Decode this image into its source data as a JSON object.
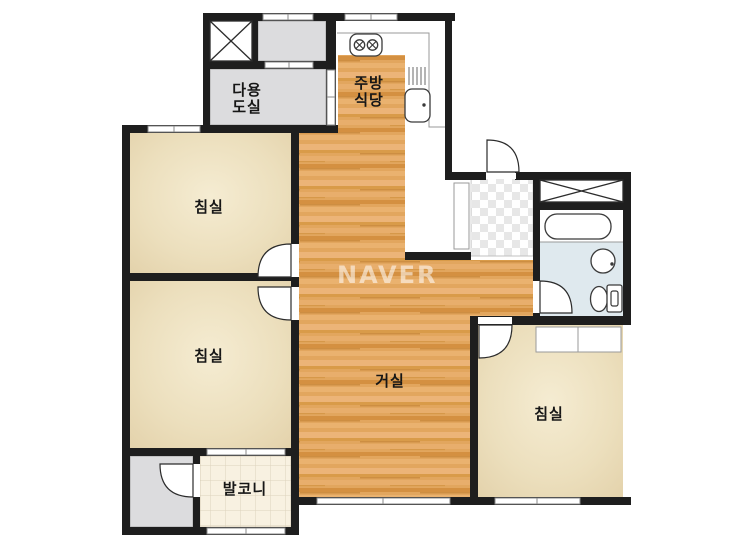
{
  "labels": {
    "utility_line1": "다용",
    "utility_line2": "도실",
    "kitchen_line1": "주방",
    "kitchen_line2": "식당",
    "bedroom_top_left": "침실",
    "bedroom_bottom_left": "침실",
    "bedroom_right": "침실",
    "living": "거실",
    "balcony": "발코니",
    "watermark": "NAVER"
  },
  "colors": {
    "wall": "#1e1e1e",
    "room_gray": "#dcdcde",
    "bath_blue": "#dfe9ee",
    "bedroom_cream": "#ecdfbd",
    "wood_floor": "#e2a65e",
    "balcony_tile": "#f8f1e1",
    "entry_checker": "#e7e7e7",
    "window_line": "#8a8a8a",
    "watermark_white": "rgba(255,255,255,0.55)"
  },
  "fixtures": {
    "stove": "stove-icon",
    "sink": "sink-icon",
    "dish_rack": "dish-rack-icon",
    "bathtub": "bathtub-icon",
    "washbasin": "washbasin-icon",
    "toilet": "toilet-icon",
    "shaft": "shaft-x-icon",
    "bath_closet": "closet-x-icon"
  }
}
